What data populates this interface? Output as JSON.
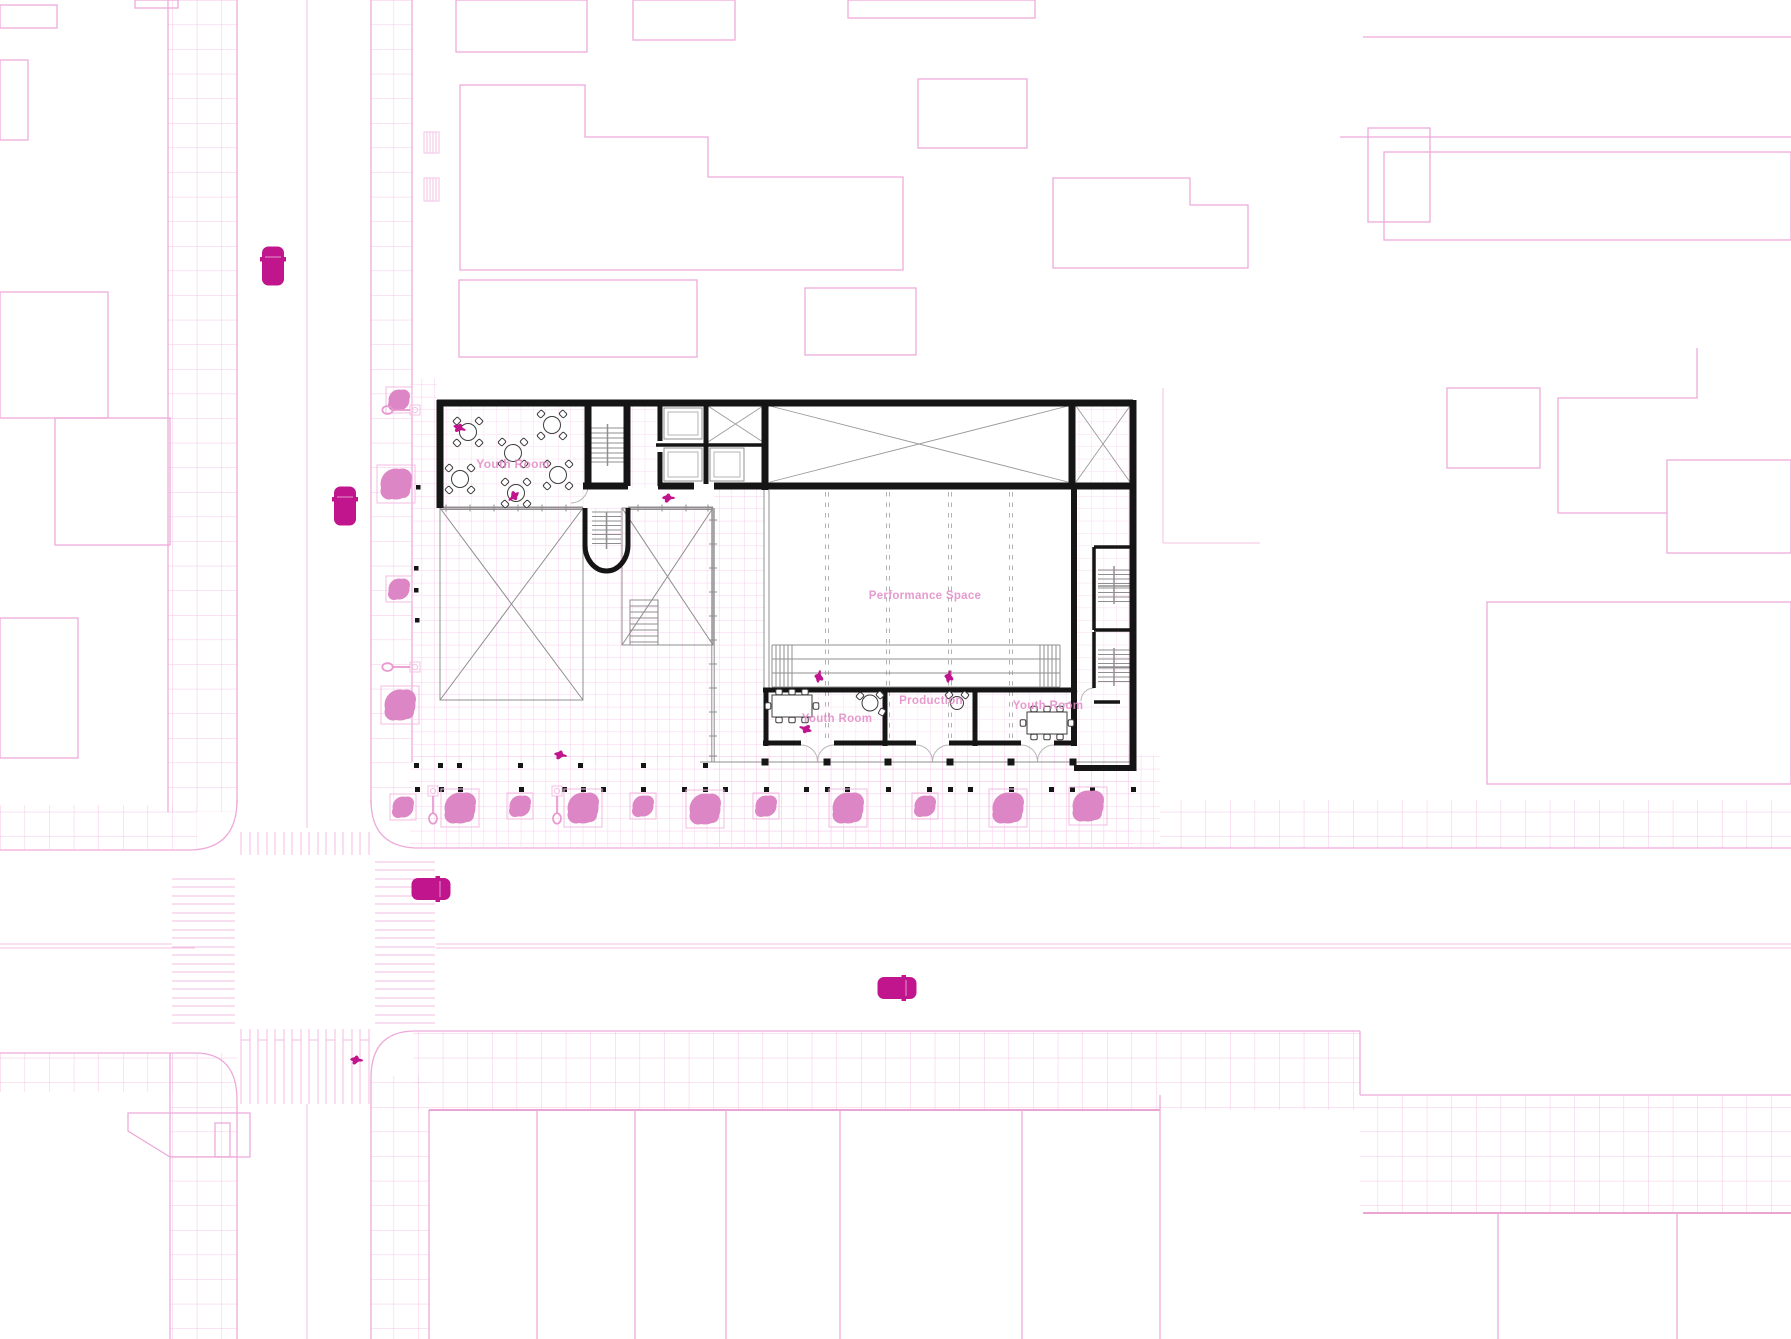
{
  "canvas": {
    "width": 1791,
    "height": 1339
  },
  "drawing_type": "architectural ground-floor site plan",
  "rooms": [
    {
      "id": "youth-room-upper",
      "label": "Youth Room"
    },
    {
      "id": "performance-space",
      "label": "Performance Space"
    },
    {
      "id": "production",
      "label": "Production"
    },
    {
      "id": "youth-room-lower-left",
      "label": "Youth Room"
    },
    {
      "id": "youth-room-lower-right",
      "label": "Youth Room"
    }
  ],
  "colors": {
    "magenta": "#c0158c",
    "tree": "#dd86c6",
    "pink_line": "#eeaada",
    "pink_strong": "#e798cf",
    "grid": "#f7cfec",
    "grid_big": "#f4c6e6",
    "wall": "#151515",
    "detail": "#8f8f8f",
    "light_detail": "#b5b5b5",
    "label": "#e289c6",
    "paper": "#ffffff"
  },
  "entities": {
    "car_icon_count": 4,
    "tree_icon_count": 15,
    "person_icon_count": 8,
    "street_lamp_icon_count": 4,
    "bollard_rows": 2,
    "crosswalk_count": 4
  }
}
